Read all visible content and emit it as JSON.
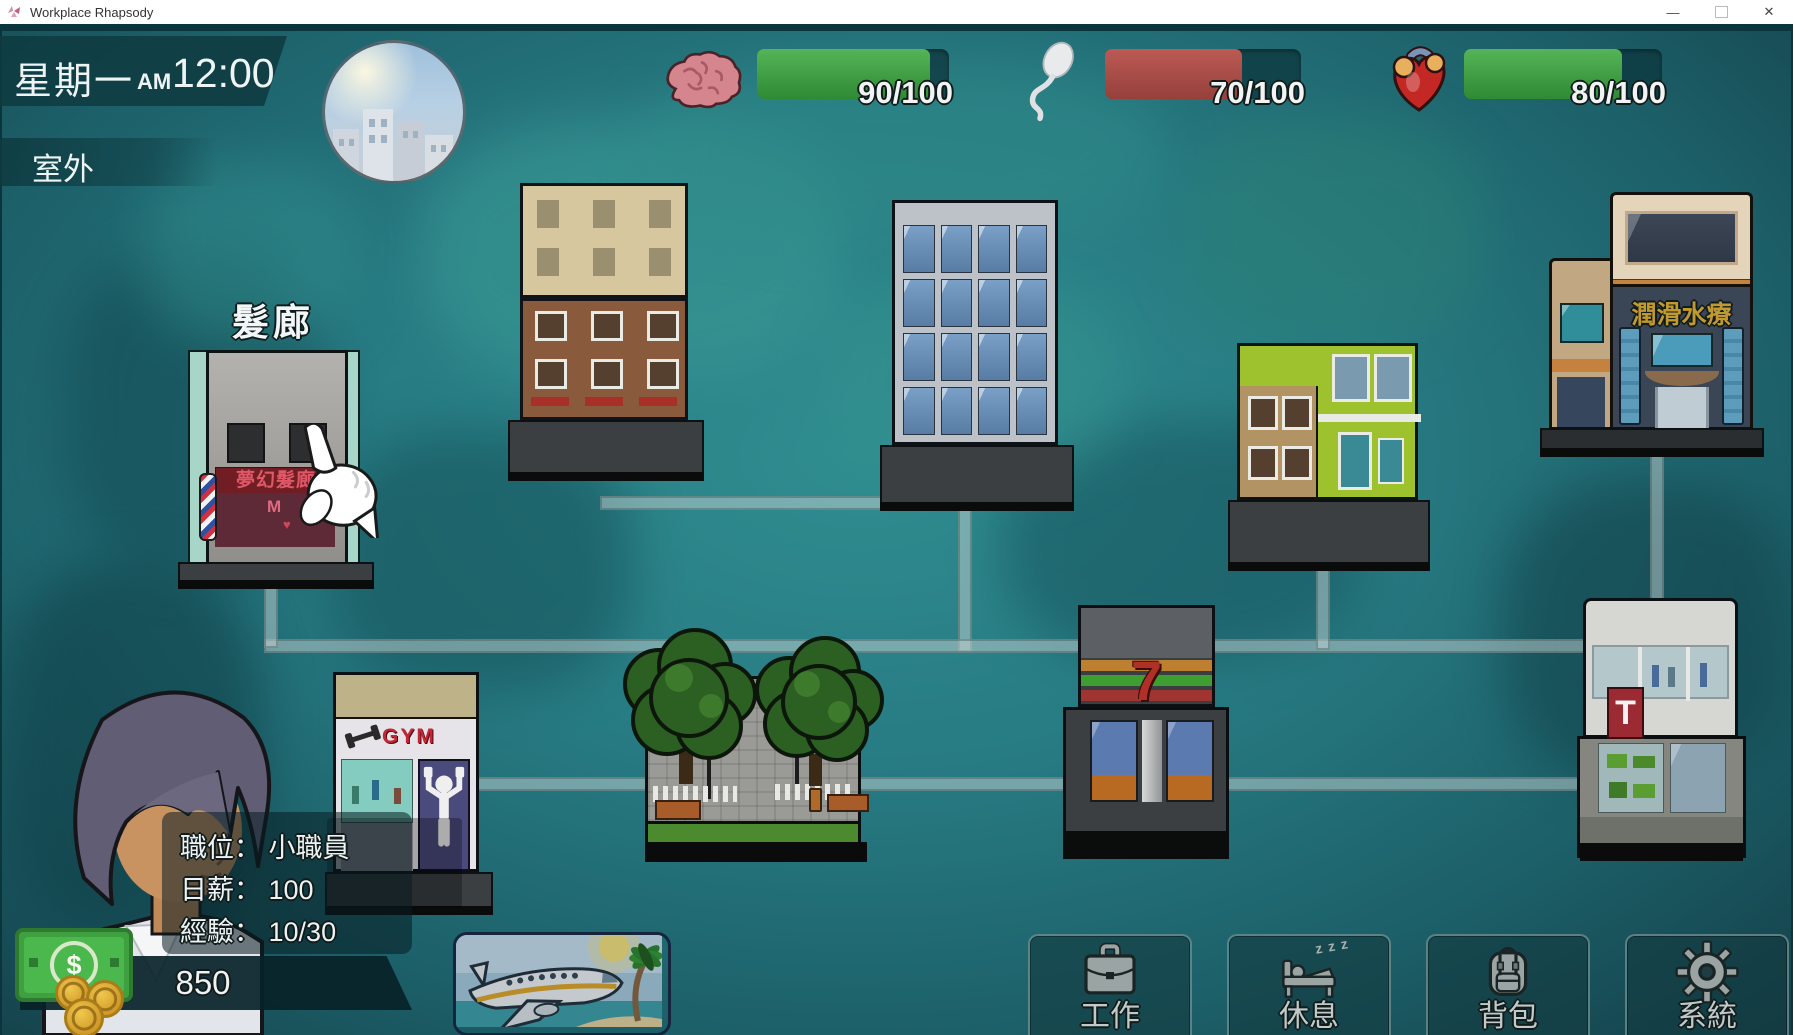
{
  "window": {
    "title": "Workplace Rhapsody",
    "minimize": "—",
    "close": "✕"
  },
  "hud": {
    "day": "星期一",
    "meridiem": "AM",
    "time": "12:00",
    "location": "室外",
    "stats": [
      {
        "id": "brain",
        "icon": "brain-icon",
        "value": "90/100",
        "pct": 90,
        "color": "#3fa344"
      },
      {
        "id": "sperm",
        "icon": "sperm-icon",
        "value": "70/100",
        "pct": 70,
        "color": "#a84a44"
      },
      {
        "id": "heart",
        "icon": "heart-icon",
        "value": "80/100",
        "pct": 80,
        "color": "#3fa344"
      }
    ]
  },
  "map": {
    "salon_label": "髮廊",
    "salon_sign": "夢幻髮廊",
    "salon_letter": "M",
    "salon_heart": "♥",
    "spa_sign": "潤滑水療",
    "gym_sign": "GYM",
    "store_sign": "7",
    "toy_sign": "T"
  },
  "player": {
    "position_label": "職位：",
    "position_value": "小職員",
    "salary_label": "日薪：",
    "salary_value": "100",
    "exp_label": "經驗：",
    "exp_value": "10/30",
    "money": "850"
  },
  "actions": {
    "work": "工作",
    "rest": "休息",
    "zzz": "z z z",
    "bag": "背包",
    "system": "系統"
  },
  "colors": {
    "bar_green": "#3fa344",
    "bar_red": "#a84a44",
    "bar_track": "#10434a",
    "hud_banner": "#0e3a40"
  }
}
